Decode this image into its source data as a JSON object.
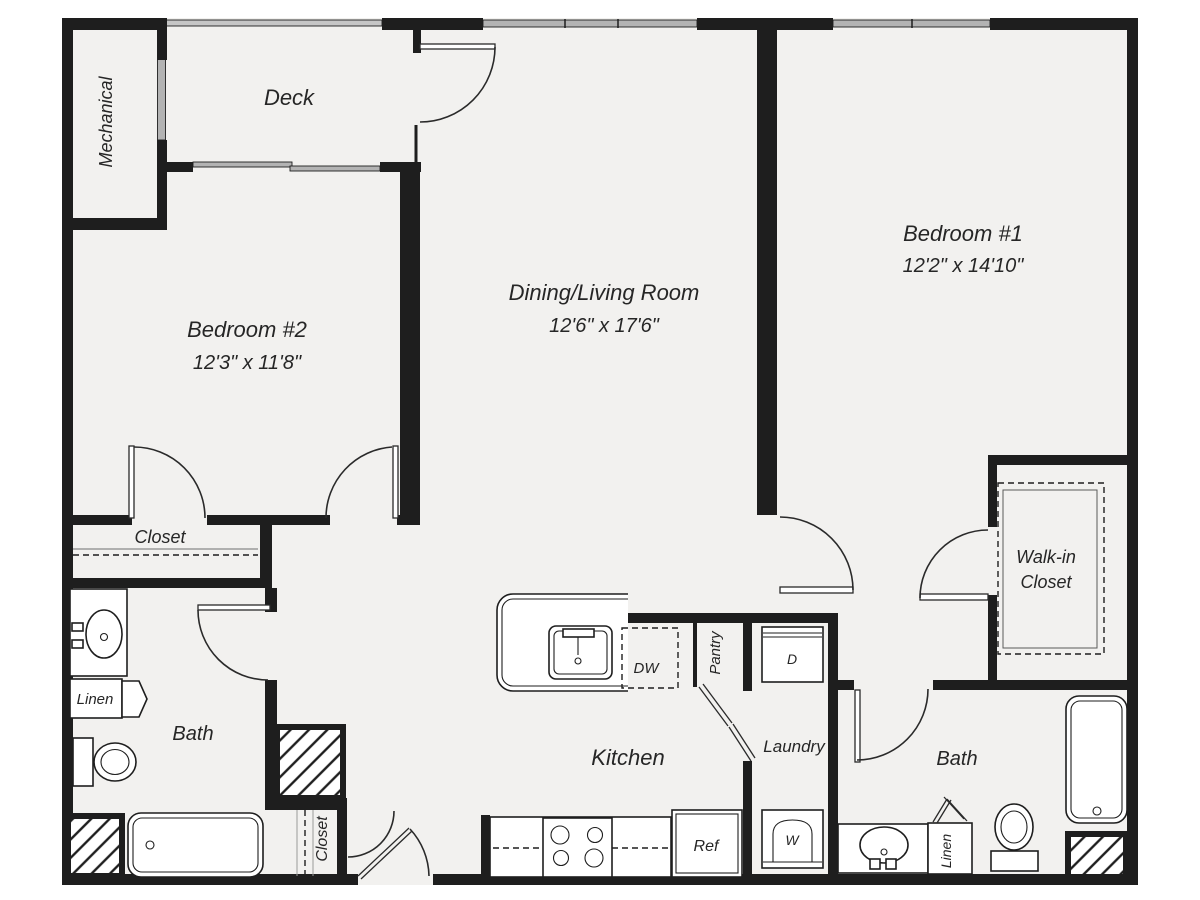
{
  "rooms": {
    "deck": {
      "label": "Deck"
    },
    "mechanical": {
      "label": "Mechanical"
    },
    "bedroom2": {
      "label": "Bedroom #2",
      "dims": "12'3\" x 11'8\""
    },
    "living": {
      "label": "Dining/Living Room",
      "dims": "12'6\" x 17'6\""
    },
    "bedroom1": {
      "label": "Bedroom #1",
      "dims": "12'2\" x 14'10\""
    },
    "bedroom2_closet": {
      "label": "Closet"
    },
    "hall_closet": {
      "label": "Closet"
    },
    "walk_in_closet": {
      "line1": "Walk-in",
      "line2": "Closet"
    },
    "bath_left": {
      "label": "Bath"
    },
    "bath_right": {
      "label": "Bath"
    },
    "linen_left": {
      "label": "Linen"
    },
    "linen_right": {
      "label": "Linen"
    },
    "kitchen": {
      "label": "Kitchen"
    },
    "pantry": {
      "label": "Pantry"
    },
    "laundry": {
      "label": "Laundry"
    }
  },
  "appliances": {
    "dishwasher": "DW",
    "refrigerator": "Ref",
    "washer": "W",
    "dryer": "D"
  },
  "colors": {
    "wall": "#1e1e1e",
    "floor": "#f2f1ef",
    "window_gray": "#b3b3b3",
    "text": "#262626"
  }
}
